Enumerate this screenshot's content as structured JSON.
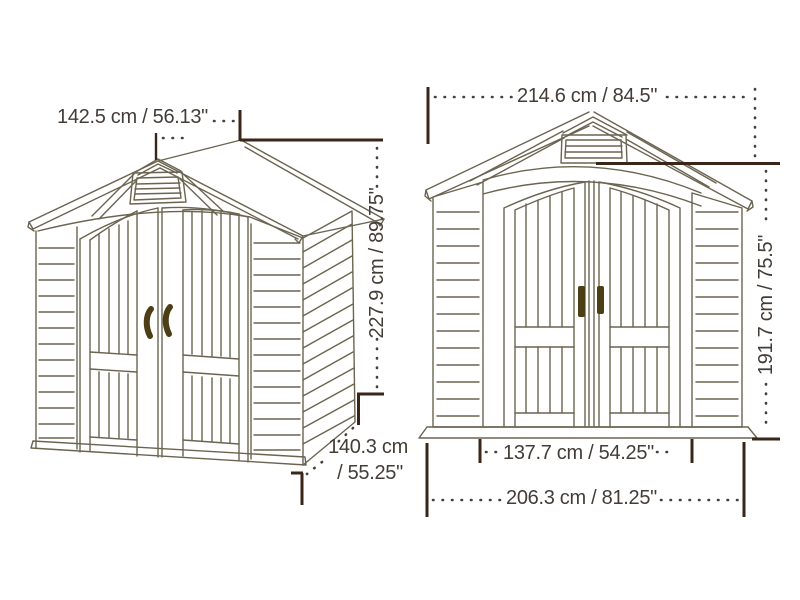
{
  "diagram": {
    "subject": "storage-shed-dimension-diagram",
    "views": {
      "perspective": {
        "dimensions": {
          "roof_depth": {
            "label": "142.5 cm / 56.13\"",
            "cm": 142.5,
            "inches": 56.13
          },
          "height": {
            "label": "227.9 cm / 89.75\"",
            "cm": 227.9,
            "inches": 89.75
          },
          "floor_depth": {
            "label_line1": "140.3 cm",
            "label_line2": "/ 55.25\"",
            "cm": 140.3,
            "inches": 55.25
          }
        }
      },
      "front_elevation": {
        "dimensions": {
          "overall_width": {
            "label": "214.6 cm / 84.5\"",
            "cm": 214.6,
            "inches": 84.5
          },
          "door_height": {
            "label": "191.7 cm / 75.5\"",
            "cm": 191.7,
            "inches": 75.5
          },
          "door_width": {
            "label": "137.7 cm / 54.25\"",
            "cm": 137.7,
            "inches": 54.25
          },
          "base_width": {
            "label": "206.3 cm / 81.25\"",
            "cm": 206.3,
            "inches": 81.25
          }
        }
      }
    },
    "colors": {
      "drawing_line": "#6a6450",
      "dimension_line": "#3a2519",
      "dotted_leader": "#45403b",
      "text": "#433d37",
      "handle": "#4c3f16",
      "background": "#ffffff"
    }
  }
}
